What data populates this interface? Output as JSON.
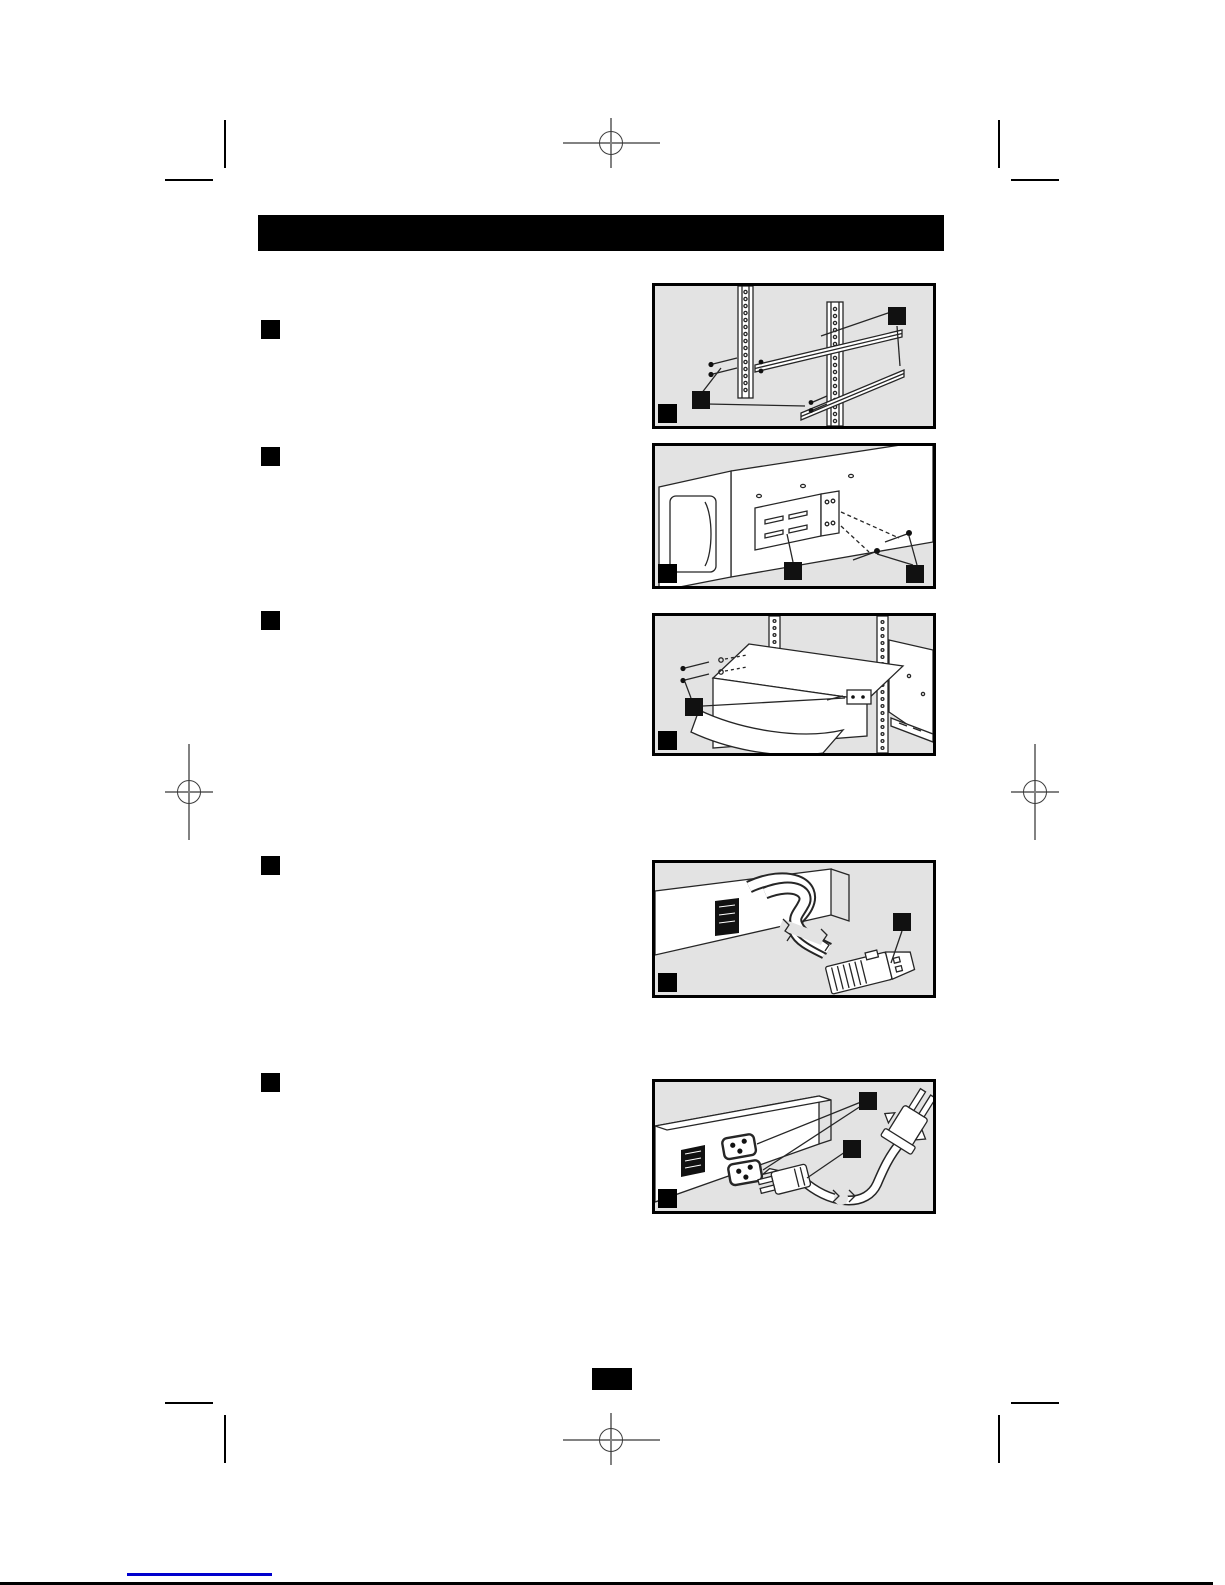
{
  "document": {
    "kind": "scanned instruction manual page (rack-mount UPS installation)",
    "header_bar_text": "",
    "page_number_text": ""
  },
  "colors": {
    "ink": "#000000",
    "figure_background": "#e3e3e3",
    "registration_line": "#828282",
    "registration_circle": "#3c3c3c",
    "link_line": "#0000cd"
  },
  "steps": [
    {
      "marker": "filled-black-square",
      "label": "",
      "figure": "attach-mounting-rails-to-rack-posts",
      "callout_count": 2
    },
    {
      "marker": "filled-black-square",
      "label": "",
      "figure": "attach-mounting-bracket-to-unit",
      "callout_count": 2
    },
    {
      "marker": "filled-black-square",
      "label": "",
      "figure": "slide-unit-into-rack-on-rails",
      "callout_count": 1
    },
    {
      "marker": "filled-black-square",
      "label": "",
      "figure": "external-battery-pack-connector-cable",
      "callout_count": 1
    },
    {
      "marker": "filled-black-square",
      "label": "",
      "figure": "connect-power-cord-to-rear-outlets",
      "callout_count": 2
    }
  ],
  "footer": {
    "has_page_number_box": true,
    "has_link_underline": true
  }
}
